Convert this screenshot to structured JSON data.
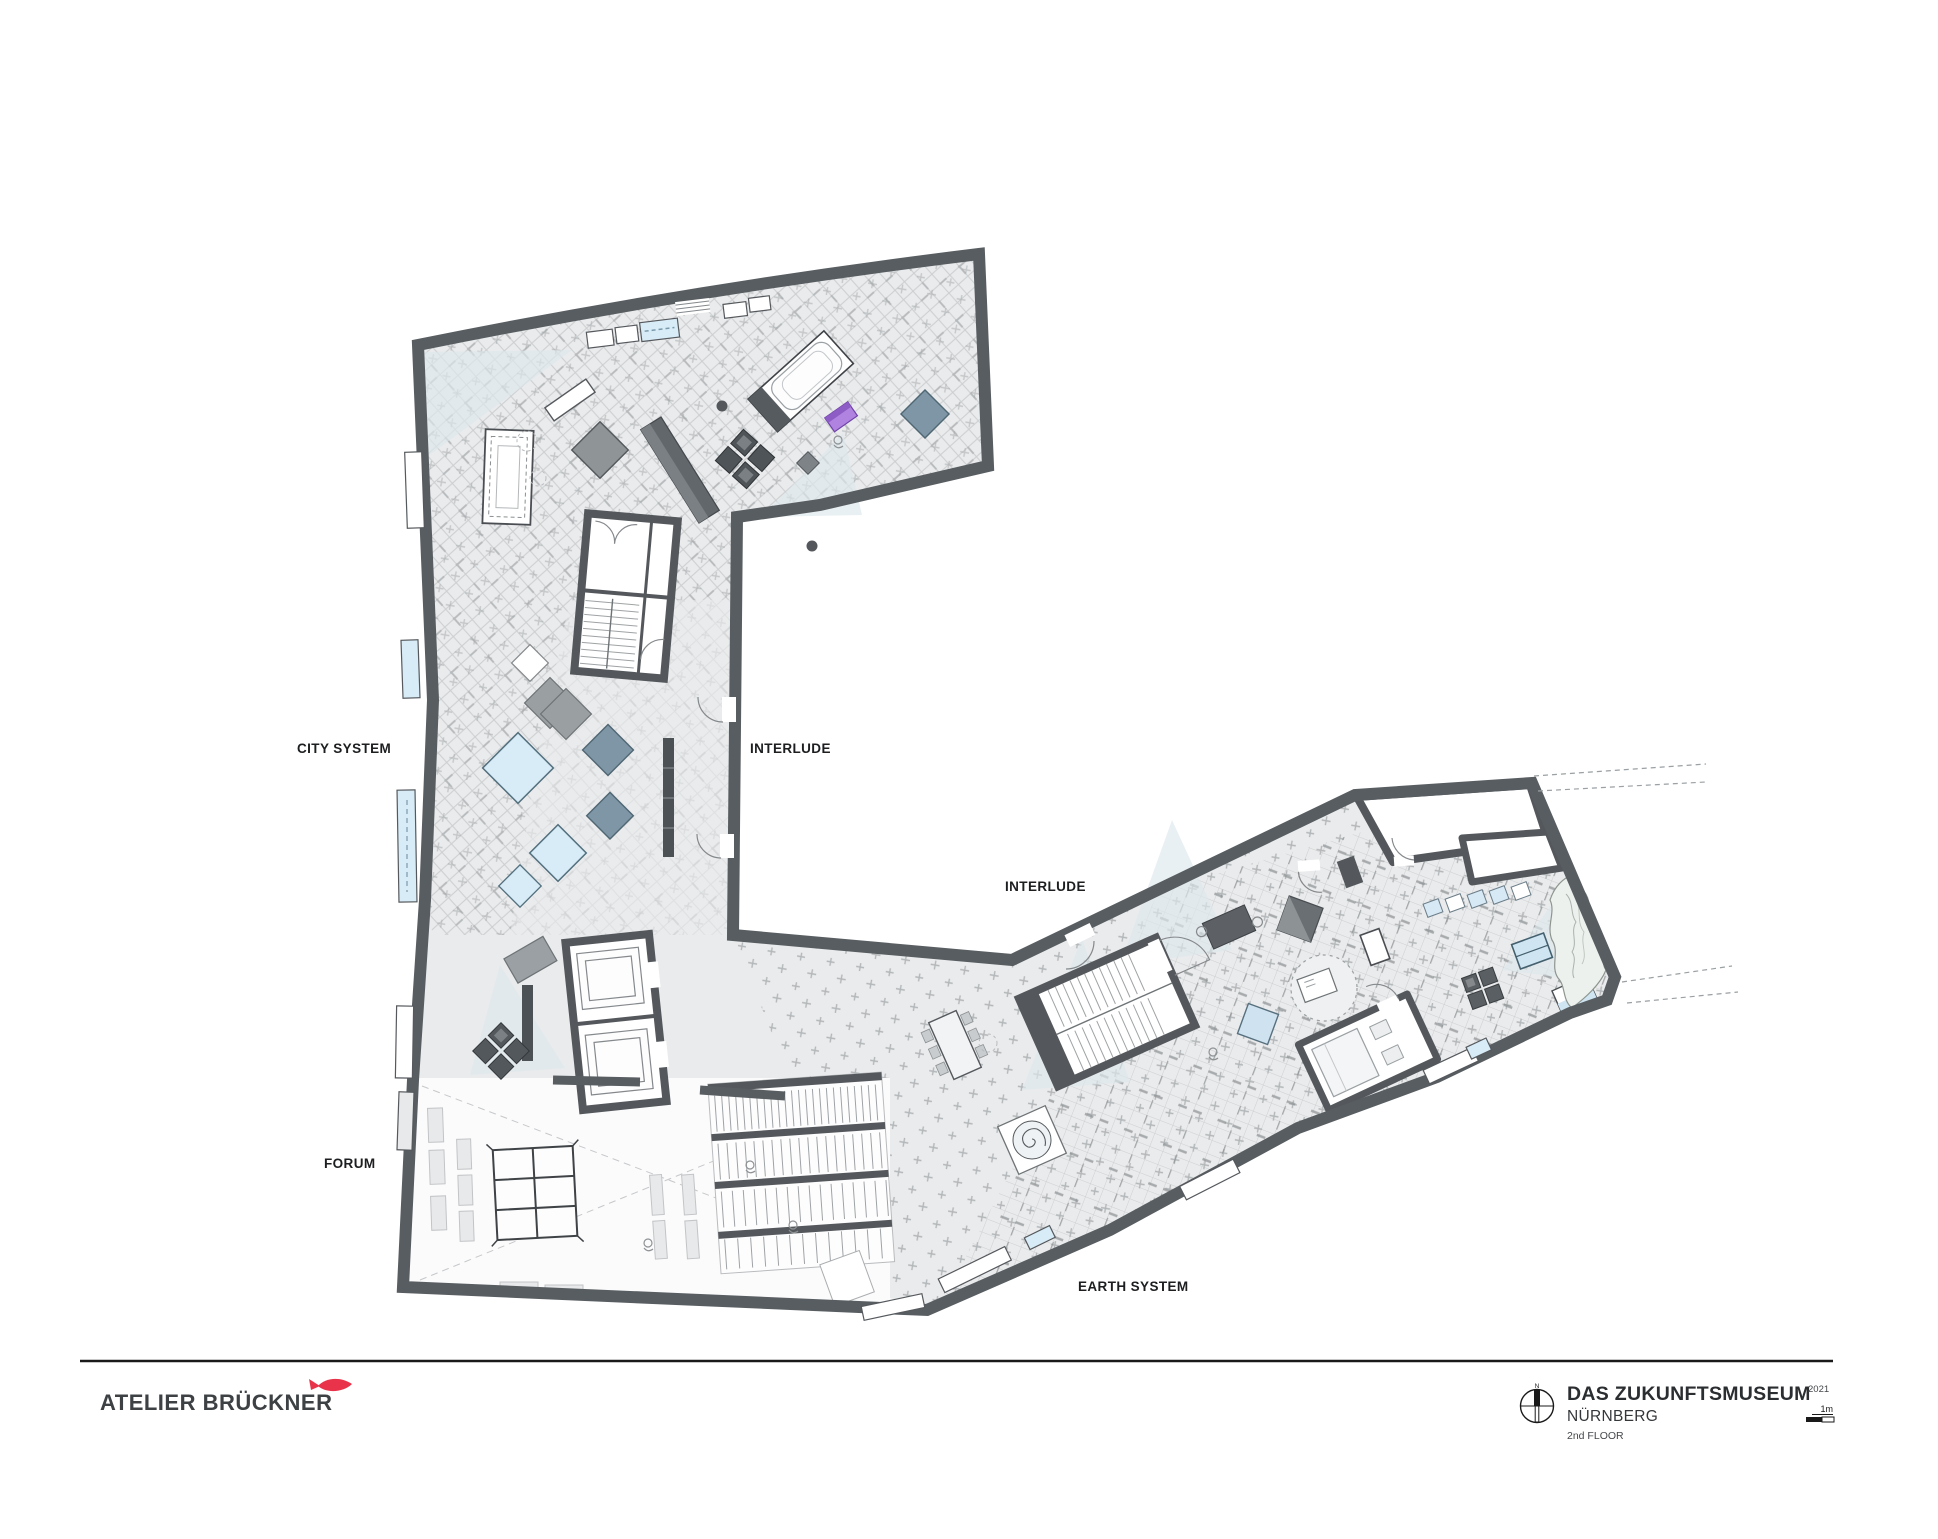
{
  "plan": {
    "labels": {
      "city_system": "CITY SYSTEM",
      "interlude_1": "INTERLUDE",
      "interlude_2": "INTERLUDE",
      "forum": "FORUM",
      "earth_system": "EARTH SYSTEM"
    }
  },
  "footer": {
    "studio": "ATELIER BRÜCKNER",
    "project": "DAS ZUKUNFTSMUSEUM",
    "year": "2021",
    "city": "NÜRNBERG",
    "floor": "2nd FLOOR",
    "scale_label": "1m",
    "north_label": "N"
  },
  "colors": {
    "wall": "#585d61",
    "floor": "#eaebec",
    "hatch": "#c5c8ca",
    "street_grid": "#b0b4b6",
    "exhibit_blue": "#d8ecf7",
    "exhibit_steel": "#7e96a6",
    "exhibit_purple": "#b183e0",
    "exhibit_green": "#8fbf97",
    "accent_red": "#e8334a",
    "cone_blue": "#dde8ec"
  }
}
